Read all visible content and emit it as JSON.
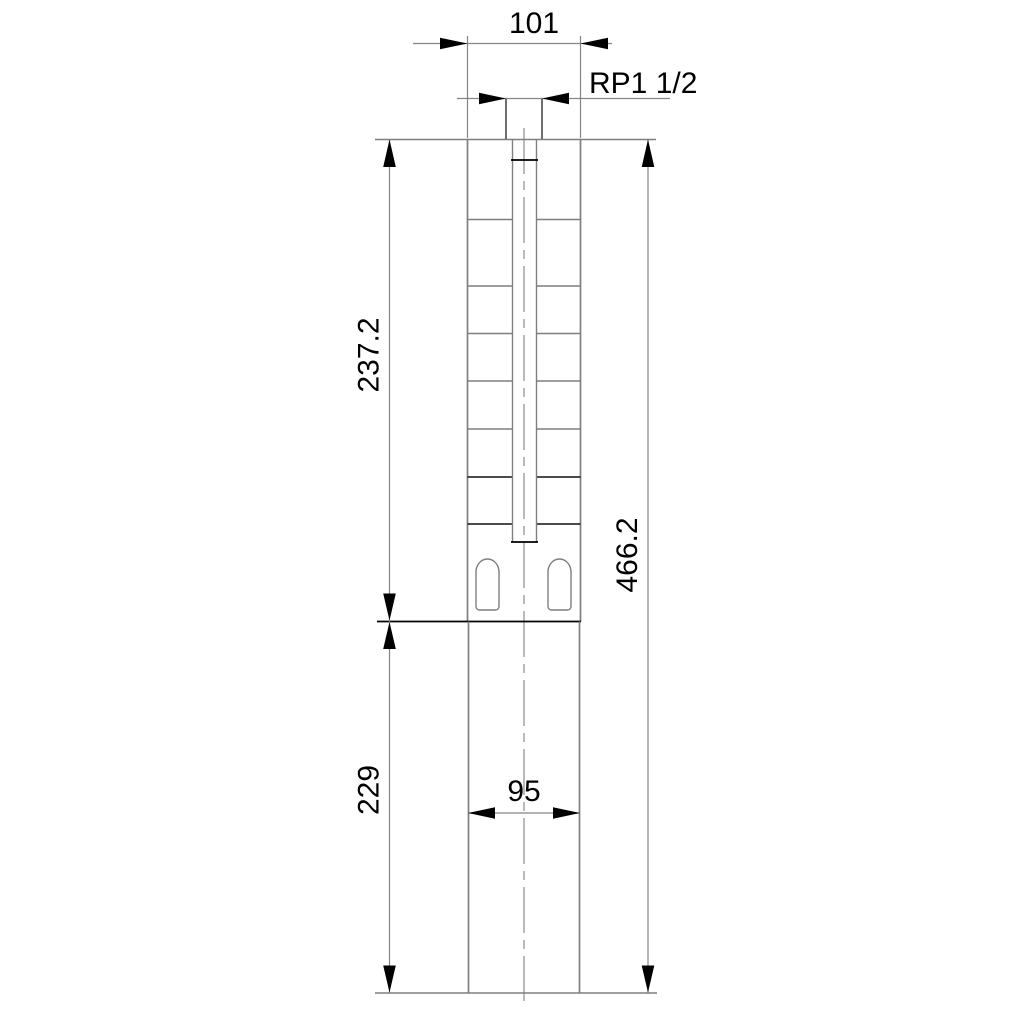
{
  "drawing": {
    "type": "technical-dimension-drawing",
    "subject": "submersible-borehole-pump-outline",
    "labels": {
      "width_top": "101",
      "thread_connection": "RP1 1/2",
      "pump_section_length": "237.2",
      "total_length": "466.2",
      "motor_section_length": "229",
      "width_motor": "95"
    },
    "colors": {
      "background": "#ffffff",
      "outline_gray": "#7f7f7f",
      "feature_black": "#000000",
      "text": "#000000"
    }
  }
}
